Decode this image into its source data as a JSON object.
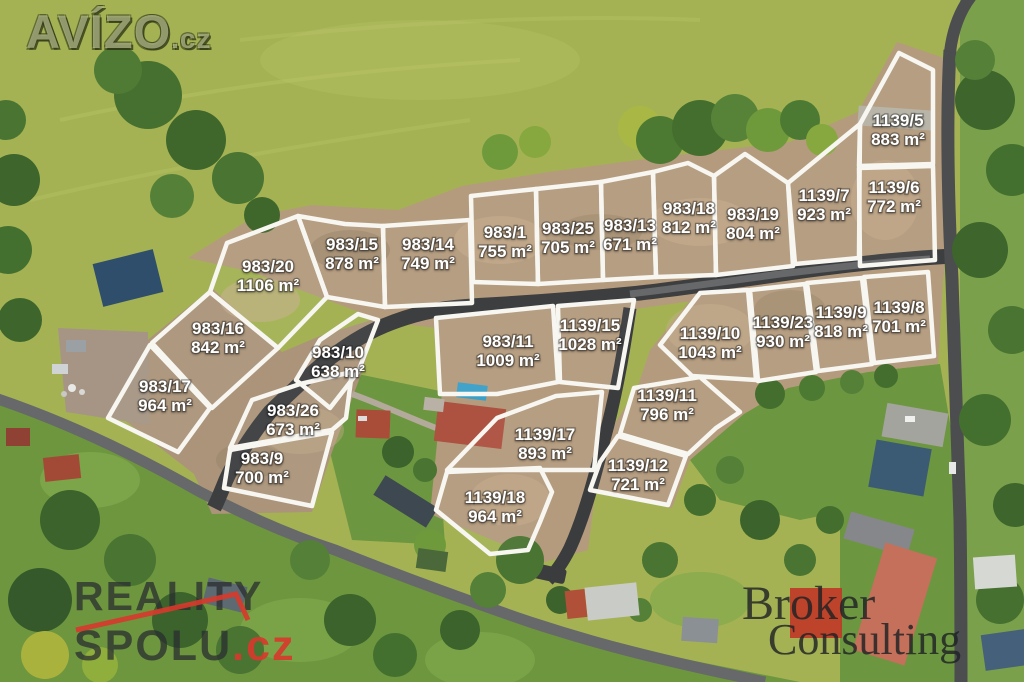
{
  "watermarks": {
    "avizo": {
      "name": "AVÍZO",
      "tld": ".cz"
    },
    "reality_spolu": {
      "line1": "REALITY",
      "line2": "SPOLU",
      "tld": ".cz"
    },
    "broker_consulting": {
      "line1": "Broker",
      "line2": "Consulting"
    }
  },
  "colors": {
    "meadow": "#a4b254",
    "village_green": "#6e963f",
    "dirt": "#b49b7d",
    "road_dark": "#3d3e3f",
    "road_village": "#66686a",
    "plot_line": "#f7f6f1",
    "label_text": "#ffffff",
    "reality_red": "#d63a2c",
    "broker_red": "#bf3a28"
  },
  "map": {
    "unit": "m²",
    "plots": [
      {
        "id": "983/20",
        "area": "1106 m²",
        "label": [
          268,
          272
        ],
        "points": "227,243 298,216 327,297 278,348 210,292"
      },
      {
        "id": "983/15",
        "area": "878 m²",
        "label": [
          352,
          250
        ],
        "points": "298,216 345,224 383,226 385,307 327,297"
      },
      {
        "id": "983/14",
        "area": "749 m²",
        "label": [
          428,
          250
        ],
        "points": "383,226 470,220 472,303 385,307"
      },
      {
        "id": "983/1",
        "area": "755 m²",
        "label": [
          505,
          238
        ],
        "points": "471,196 536,189 538,284 473,282"
      },
      {
        "id": "983/25",
        "area": "705 m²",
        "label": [
          568,
          234
        ],
        "points": "536,189 601,182 603,280 538,284"
      },
      {
        "id": "983/13",
        "area": "671 m²",
        "label": [
          630,
          231
        ],
        "points": "601,182 653,172 656,277 603,280"
      },
      {
        "id": "983/18",
        "area": "812 m²",
        "label": [
          689,
          214
        ],
        "points": "653,172 688,163 714,176 716,275 656,277"
      },
      {
        "id": "983/19",
        "area": "804 m²",
        "label": [
          753,
          220
        ],
        "points": "714,176 745,154 788,183 793,266 716,275"
      },
      {
        "id": "1139/7",
        "area": "923 m²",
        "label": [
          824,
          201
        ],
        "points": "788,183 860,124 859,258 795,264"
      },
      {
        "id": "1139/6",
        "area": "772 m²",
        "label": [
          894,
          193
        ],
        "points": "859,168 933,166 935,260 860,266"
      },
      {
        "id": "1139/5",
        "area": "883 m²",
        "label": [
          898,
          126
        ],
        "points": "899,53 933,70 933,164 859,166 860,124"
      },
      {
        "id": "983/16",
        "area": "842 m²",
        "label": [
          218,
          334
        ],
        "points": "210,292 278,348 212,408 152,343"
      },
      {
        "id": "983/17",
        "area": "964 m²",
        "label": [
          165,
          392
        ],
        "points": "150,345 210,408 178,452 108,418"
      },
      {
        "id": "983/10",
        "area": "638 m²",
        "label": [
          338,
          358
        ],
        "points": "320,340 358,314 378,320 358,372 330,408 296,380"
      },
      {
        "id": "983/26",
        "area": "673 m²",
        "label": [
          293,
          416
        ],
        "points": "252,400 300,384 352,372 346,418 332,430 230,448"
      },
      {
        "id": "983/9",
        "area": "700 m²",
        "label": [
          262,
          464
        ],
        "points": "230,450 332,432 312,506 224,488"
      },
      {
        "id": "983/11",
        "area": "1009 m²",
        "label": [
          508,
          347
        ],
        "points": "436,318 553,306 558,382 497,394 440,394"
      },
      {
        "id": "1139/15",
        "area": "1028 m²",
        "label": [
          590,
          331
        ],
        "points": "558,306 634,300 618,388 560,382"
      },
      {
        "id": "1139/10",
        "area": "1043 m²",
        "label": [
          710,
          339
        ],
        "points": "660,345 700,293 748,290 756,380 692,376"
      },
      {
        "id": "1139/23",
        "area": "930 m²",
        "label": [
          783,
          328
        ],
        "points": "750,290 805,284 816,372 758,381"
      },
      {
        "id": "1139/9",
        "area": "818 m²",
        "label": [
          841,
          318
        ],
        "points": "807,283 862,278 872,364 818,371"
      },
      {
        "id": "1139/8",
        "area": "701 m²",
        "label": [
          899,
          313
        ],
        "points": "864,277 928,272 934,356 874,363"
      },
      {
        "id": "1139/11",
        "area": "796 m²",
        "label": [
          667,
          401
        ],
        "points": "634,388 700,377 740,412 716,428 688,454 620,434"
      },
      {
        "id": "1139/17",
        "area": "893 m²",
        "label": [
          545,
          440
        ],
        "points": "497,418 556,396 602,392 594,470 447,470"
      },
      {
        "id": "1139/12",
        "area": "721 m²",
        "label": [
          638,
          471
        ],
        "points": "618,436 686,456 668,505 590,490 600,462"
      },
      {
        "id": "1139/18",
        "area": "964 m²",
        "label": [
          495,
          503
        ],
        "points": "447,472 540,468 552,492 540,522 528,550 490,554 436,510"
      }
    ]
  }
}
